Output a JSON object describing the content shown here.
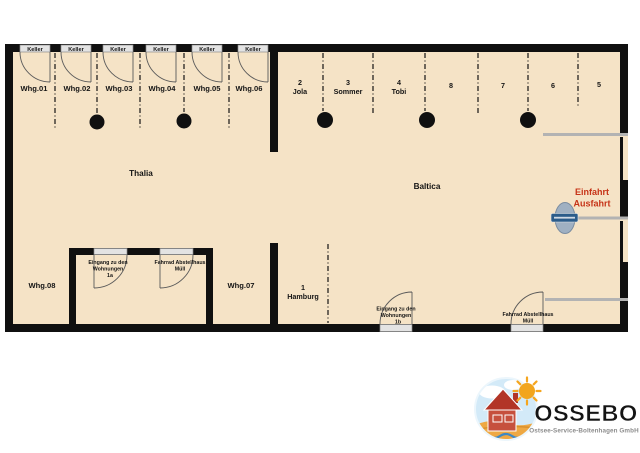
{
  "plan": {
    "building_left": "Thalia",
    "building_right": "Baltica",
    "keller_label": "Keller",
    "apartments_top": [
      "Whg.01",
      "Whg.02",
      "Whg.03",
      "Whg.04",
      "Whg.05",
      "Whg.06"
    ],
    "apartment_bottom_left": "Whg.08",
    "apartment_bottom_right": "Whg.07",
    "parking_top": [
      {
        "number": "2",
        "name": "Jola"
      },
      {
        "number": "3",
        "name": "Sommer"
      },
      {
        "number": "4",
        "name": "Tobi"
      },
      {
        "number": "8",
        "name": ""
      },
      {
        "number": "7",
        "name": ""
      },
      {
        "number": "6",
        "name": ""
      },
      {
        "number": "5",
        "name": ""
      }
    ],
    "parking_bottom": {
      "number": "1",
      "name": "Hamburg"
    },
    "entrance_1a": {
      "line1": "Eingang zu den",
      "line2": "Wohnungen",
      "line3": "1a"
    },
    "bike_shed_left": {
      "line1": "Fahrrad Abstellhaus",
      "line2": "Müll"
    },
    "entrance_1b": {
      "line1": "Eingang zu den",
      "line2": "Wohnungen",
      "line3": "1b"
    },
    "bike_shed_right": {
      "line1": "Fahrrad Abstellhaus",
      "line2": "Müll"
    },
    "gate": {
      "line1": "Einfahrt",
      "line2": "Ausfahrt"
    }
  },
  "logo": {
    "brand": "OSSEBO",
    "subtitle": "Ostsee-Service-Boltenhagen GmbH"
  },
  "colors": {
    "floor": "#f5e3c6",
    "wall": "#101010",
    "door_fill": "#e3e3e3",
    "fence_gray": "#b3b3b3",
    "gate_text": "#c63418",
    "brand_blue": "#3f93cf",
    "subtitle_gray": "#8c8c8c"
  }
}
